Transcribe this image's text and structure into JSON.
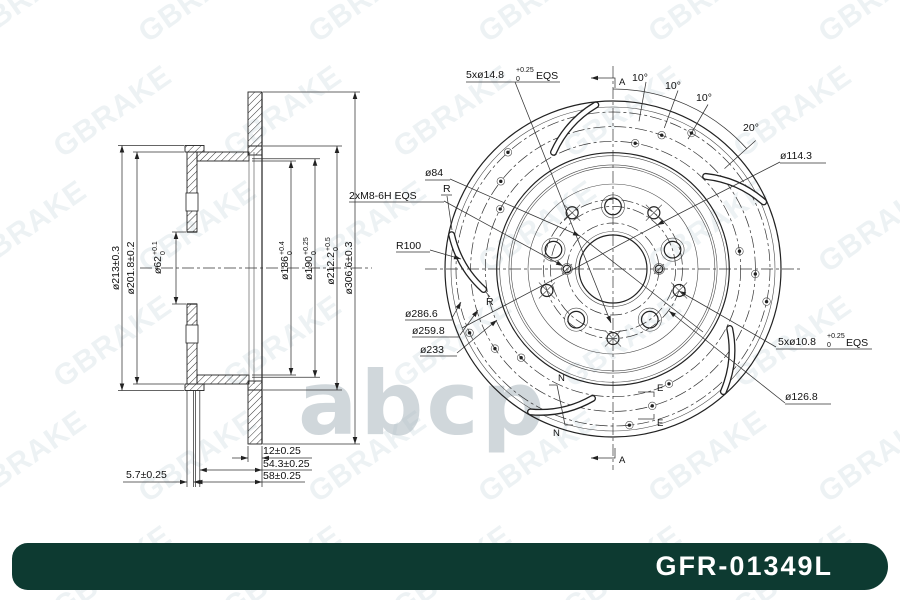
{
  "watermark": {
    "brand": "GBRAKE",
    "abcp": "abcp"
  },
  "banner": {
    "part_number": "GFR-01349L",
    "bg": "#0d3a31",
    "fg": "#ffffff"
  },
  "section_view": {
    "dim_213": "ø213±0.3",
    "dim_201": "ø201.8±0.2",
    "dim_62": {
      "main": "ø62",
      "sup": "+0.1",
      "sub": "0"
    },
    "dim_186": {
      "main": "ø186",
      "sup": "+0.4",
      "sub": "0"
    },
    "dim_190": {
      "main": "ø190",
      "sup": "+0.25",
      "sub": "0"
    },
    "dim_212": {
      "main": "ø212.2",
      "sup": "+0.5",
      "sub": "0"
    },
    "dim_306": "ø306.6±0.3",
    "dim_12": "12±0.25",
    "dim_543": "54.3±0.25",
    "dim_58": "58±0.25",
    "dim_57": "5.7±0.25"
  },
  "front_view": {
    "holes_outer": {
      "main": "5xø14.8",
      "sup": "+0.25",
      "sub": "0",
      "suffix": "EQS"
    },
    "holes_inner": {
      "main": "5xø10.8",
      "sup": "+0.25",
      "sub": "0",
      "suffix": "EQS"
    },
    "thread": "2xM8-6H EQS",
    "pcd": "ø114.3",
    "hub_circle": "ø84",
    "bolt_inner_circle": "ø126.8",
    "slot_circle_1": "ø286.6",
    "slot_circle_2": "ø259.8",
    "slot_circle_3": "ø233",
    "slot_radius": "R100",
    "r_mark": "R",
    "angle_10": "10°",
    "angle_20": "20°",
    "section_a": "A",
    "section_n": "N",
    "section_e": "E"
  }
}
